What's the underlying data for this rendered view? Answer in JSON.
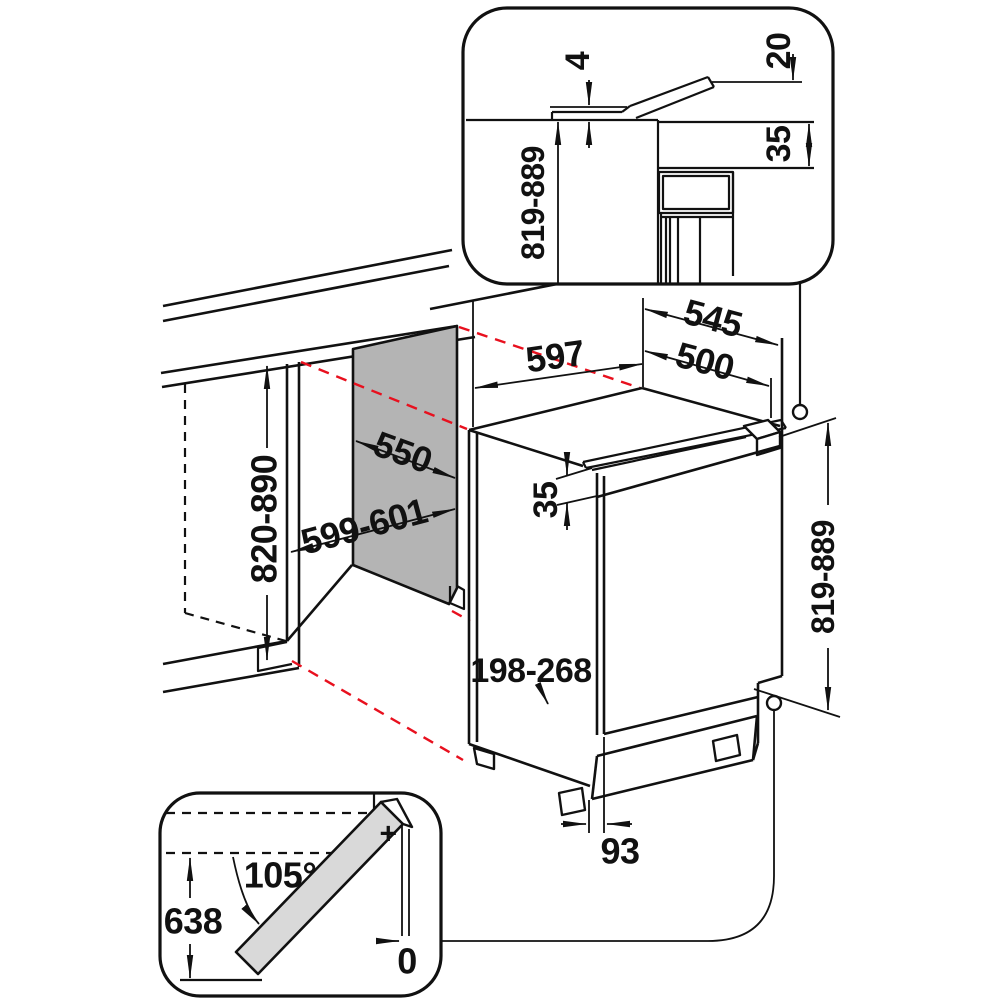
{
  "colors": {
    "line": "#111111",
    "projection_red": "#e8101e",
    "niche_panel_gray": "#b4b4b4",
    "door_panel_gray": "#d9d9d9",
    "background": "#ffffff"
  },
  "labels": {
    "inset_counter_gap": "4",
    "inset_door_overhang": "20",
    "inset_rear_vent_gap": "35",
    "inset_niche_height": "819-889",
    "fridge_width": "597",
    "depth_total": "545",
    "depth_body": "500",
    "niche_depth": "550",
    "niche_width": "599-601",
    "niche_height": "820-890",
    "top_gap": "35",
    "plinth_height_range": "198-268",
    "plinth_recess": "93",
    "fridge_height": "819-889",
    "door_opening_angle": "105°",
    "door_swing_depth": "638",
    "side_clearance_zero": "0",
    "hinge_mark": "+"
  }
}
